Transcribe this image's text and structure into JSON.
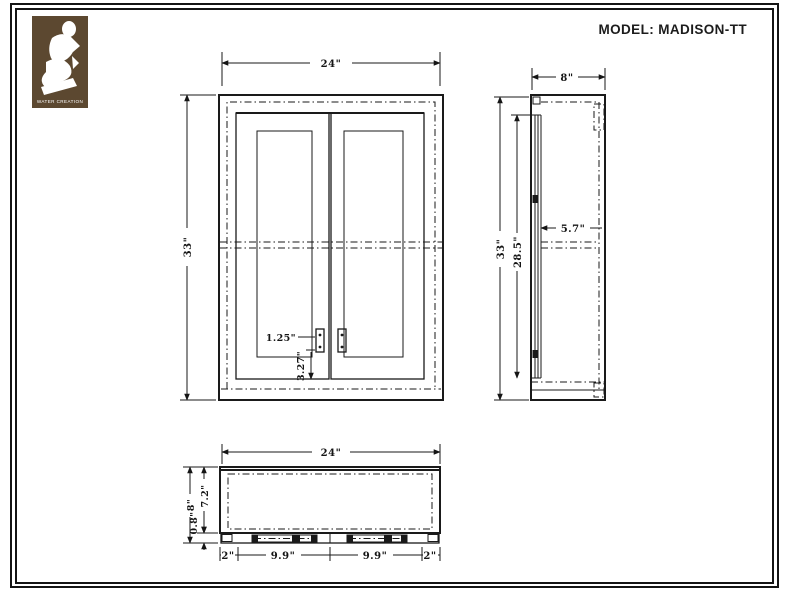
{
  "title": "MODEL: MADISON-TT",
  "logo": {
    "brand": "WATER CREATION"
  },
  "dims": {
    "front": {
      "width": "24\"",
      "height": "33\"",
      "handle_width": "1.25\"",
      "handle_offset": "3.27\""
    },
    "side": {
      "depth": "8\"",
      "height": "33\"",
      "door_height": "28.5\"",
      "inner_depth": "5.7\""
    },
    "plan": {
      "width": "24\"",
      "depth": "8\"",
      "body_depth": "7.2\"",
      "door_thickness": "0.8\"",
      "left_margin": "2\"",
      "left_span": "9.9\"",
      "right_span": "9.9\"",
      "right_margin": "2\""
    }
  }
}
